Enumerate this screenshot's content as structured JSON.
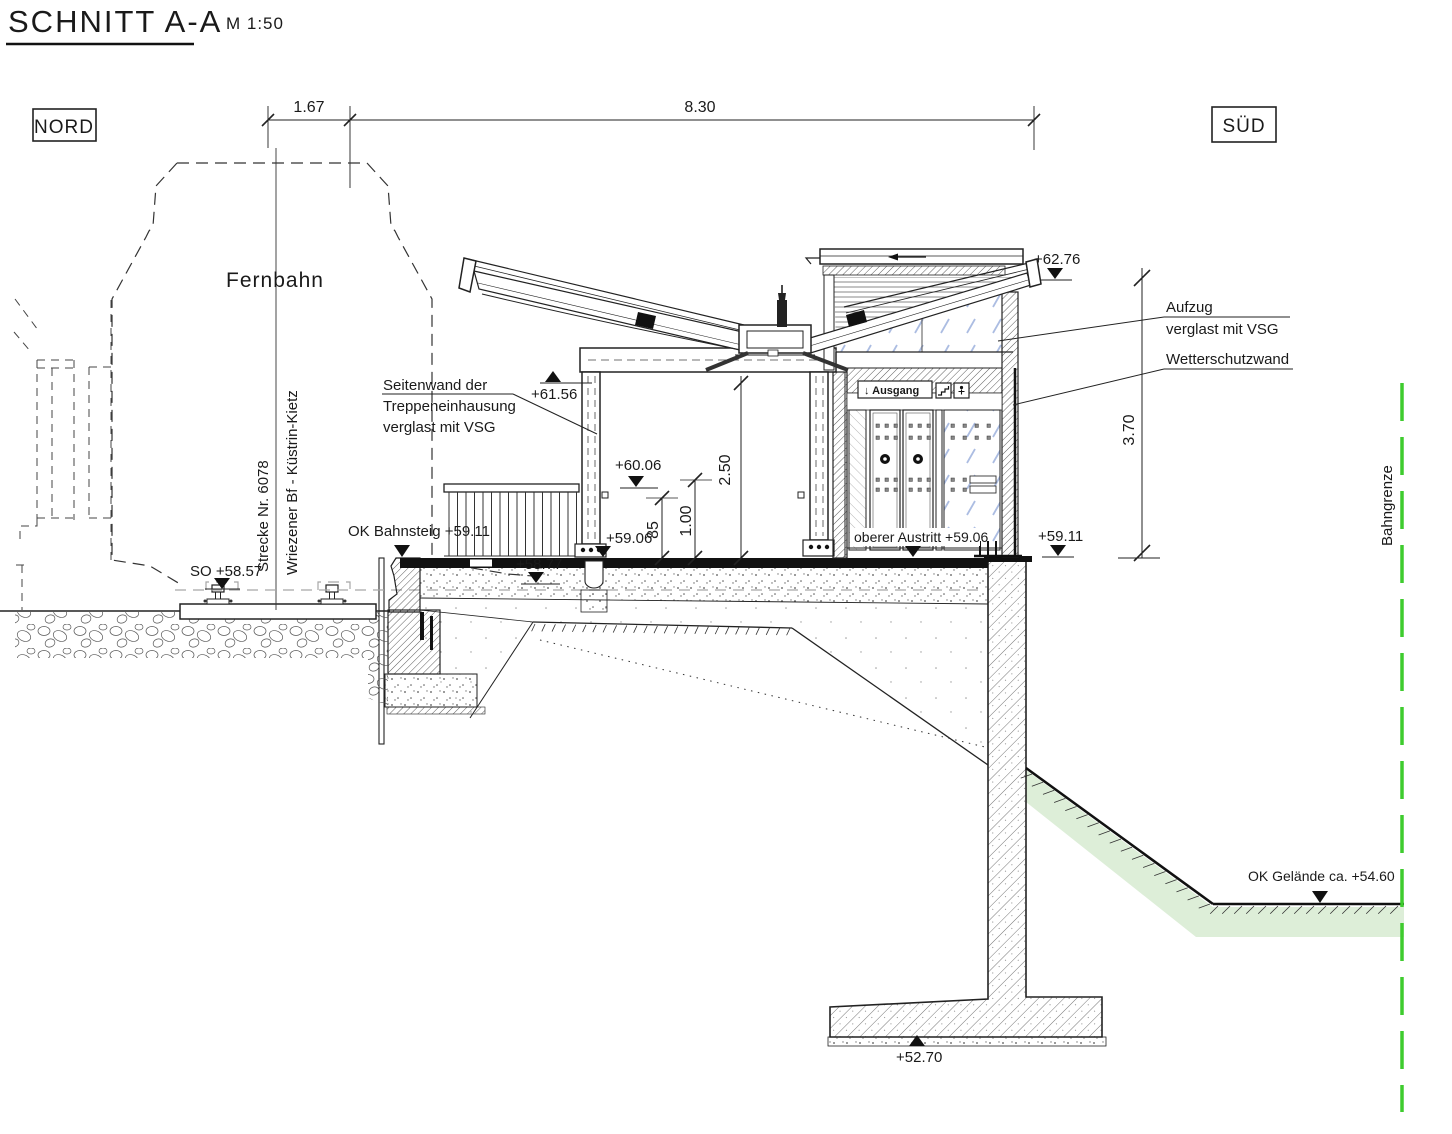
{
  "title": {
    "text": "SCHNITT A-A",
    "scale": "M 1:50"
  },
  "compass": {
    "north": "NORD",
    "south": "SÜD"
  },
  "dims": {
    "w1": "1.67",
    "w2": "8.30",
    "h250": "2.50",
    "h100": "1.00",
    "h85": "85",
    "h370": "3.70"
  },
  "levels": {
    "l6276": "+62.76",
    "l6156": "+61.56",
    "l6006": "+60.06",
    "platform": "OK Bahnsteig +59.11",
    "l5911": "+59.11",
    "austritt": "oberer Austritt +59.06",
    "l5906": "+59.06",
    "l5877": "+58.77",
    "so": "SO +58.57",
    "gelaende": "OK Gelände ca. +54.60",
    "l5270": "+52.70"
  },
  "track": {
    "name": "Fernbahn",
    "line_no": "Strecke Nr. 6078",
    "route": "Wriezener Bf - Küstrin-Kietz"
  },
  "notes": {
    "side1": "Seitenwand der",
    "side2": "Treppeneinhausung",
    "side3": "verglast mit VSG",
    "lift1": "Aufzug",
    "lift2": "verglast mit VSG",
    "weather": "Wetterschutzwand",
    "border": "Bahngrenze"
  },
  "sign": {
    "label": "↓ Ausgang"
  },
  "colors": {
    "line": "#1a1a1a",
    "green_line": "#3ecc2e",
    "green_fill": "#ddeed8",
    "glass": "#9db1dd",
    "gray": "#a6a6a6"
  }
}
